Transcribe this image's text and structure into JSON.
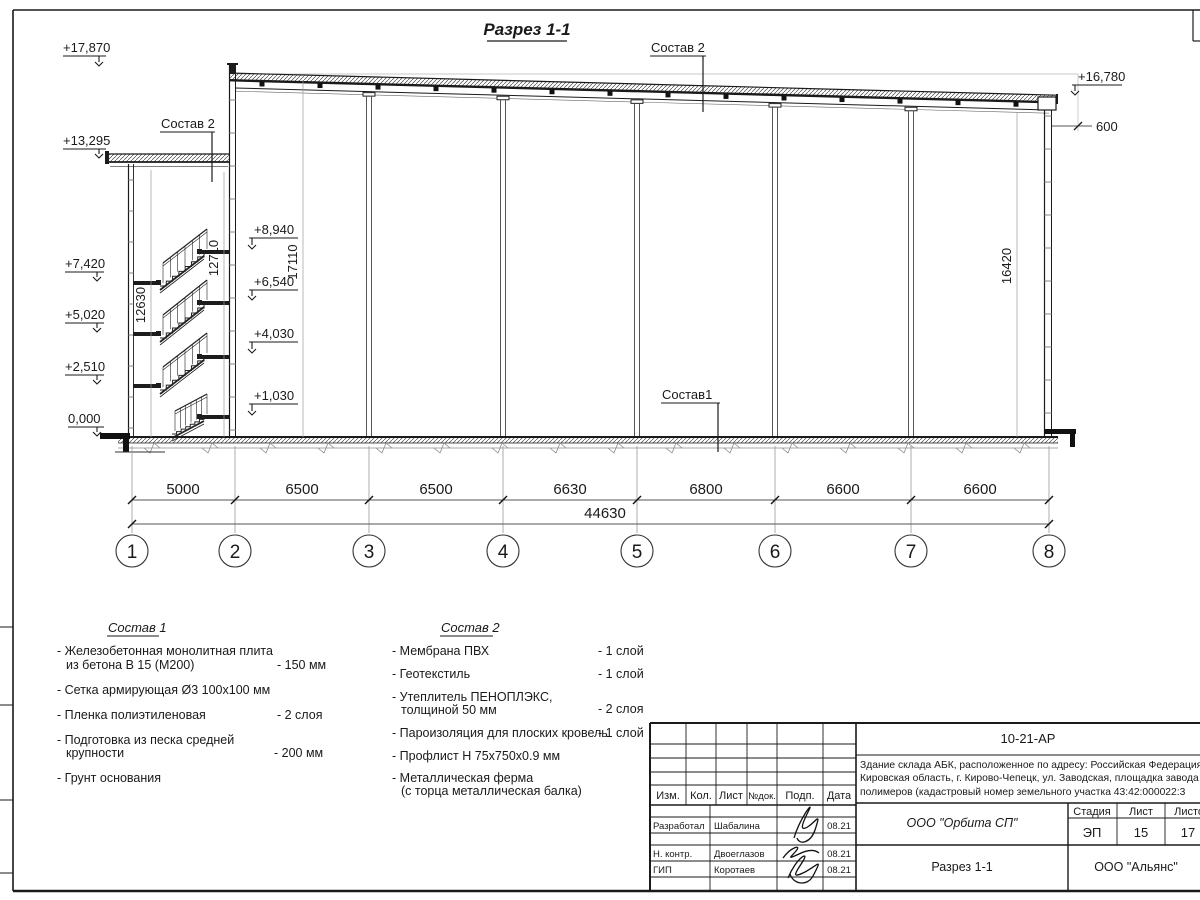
{
  "section": {
    "title": "Разрез 1-1",
    "elevations": {
      "e17870": "+17,870",
      "e16780": "+16,780",
      "e13295": "+13,295",
      "e8940": "+8,940",
      "e7420": "+7,420",
      "e6540": "+6,540",
      "e5020": "+5,020",
      "e4030": "+4,030",
      "e2510": "+2,510",
      "e1030": "+1,030",
      "e0": "0,000"
    },
    "offset_600": "600",
    "label_sostav2_annex": "Состав 2",
    "label_sostav2_roof": "Состав 2",
    "label_sostav1_floor": "Состав1",
    "vdims": {
      "v12630": "12630",
      "v12710": "12710",
      "v17110": "17110",
      "v16420": "16420"
    },
    "spans": [
      "5000",
      "6500",
      "6500",
      "6630",
      "6800",
      "6600",
      "6600"
    ],
    "total": "44630",
    "axes": [
      "1",
      "2",
      "3",
      "4",
      "5",
      "6",
      "7",
      "8"
    ]
  },
  "composition1": {
    "title": "Состав 1",
    "items": [
      {
        "line1": "- Железобетонная  монолитная плита",
        "line2": "из бетона В 15 (М200)",
        "value": "- 150 мм"
      },
      {
        "line1": "- Сетка армирующая Ø3 100х100 мм",
        "line2": "",
        "value": ""
      },
      {
        "line1": "- Пленка полиэтиленовая",
        "line2": "",
        "value": "-  2 слоя"
      },
      {
        "line1": "- Подготовка из песка средней",
        "line2": "крупности",
        "value": "- 200 мм"
      },
      {
        "line1": "- Грунт основания",
        "line2": "",
        "value": ""
      }
    ]
  },
  "composition2": {
    "title": "Состав 2",
    "items": [
      {
        "line1": "- Мембрана ПВХ",
        "line2": "",
        "value": "- 1 слой"
      },
      {
        "line1": "- Геотекстиль",
        "line2": "",
        "value": "- 1 слой"
      },
      {
        "line1": "- Утеплитель ПЕНОПЛЭКС,",
        "line2": "толщиной 50 мм",
        "value": "- 2 слоя"
      },
      {
        "line1": "- Пароизоляция для плоских кровель",
        "line2": "",
        "value": "- 1 слой"
      },
      {
        "line1": "- Профлист Н 75х750х0.9 мм",
        "line2": "",
        "value": ""
      },
      {
        "line1": "- Металлическая ферма",
        "line2": "(с торца металлическая балка)",
        "value": ""
      }
    ]
  },
  "titleblock": {
    "doc_number": "10-21-АР",
    "project_lines": [
      "Здание склада АБК, расположенное по адресу: Российская Федерация,",
      "Кировская область, г. Кирово-Чепецк, ул. Заводская, площадка завода",
      "полимеров (кадастровый номер земельного участка 43:42:000022:3"
    ],
    "columns": [
      "Изм.",
      "Кол.",
      "Лист",
      "№док.",
      "Подп.",
      "Дата"
    ],
    "signature_rows": [
      {
        "role": "Разработал",
        "name": "Шабалина",
        "date": "08.21"
      },
      {
        "role": "Н. контр.",
        "name": "Двоеглазов",
        "date": "08.21"
      },
      {
        "role": "ГИП",
        "name": "Коротаев",
        "date": "08.21"
      }
    ],
    "designer_org": "ООО \"Орбита СП\"",
    "stage_header": "Стадия",
    "sheet_header": "Лист",
    "sheets_header": "Листов",
    "stage": "ЭП",
    "sheet": "15",
    "sheets": "17",
    "view_name": "Разрез 1-1",
    "client_org": "ООО \"Альянс\""
  }
}
